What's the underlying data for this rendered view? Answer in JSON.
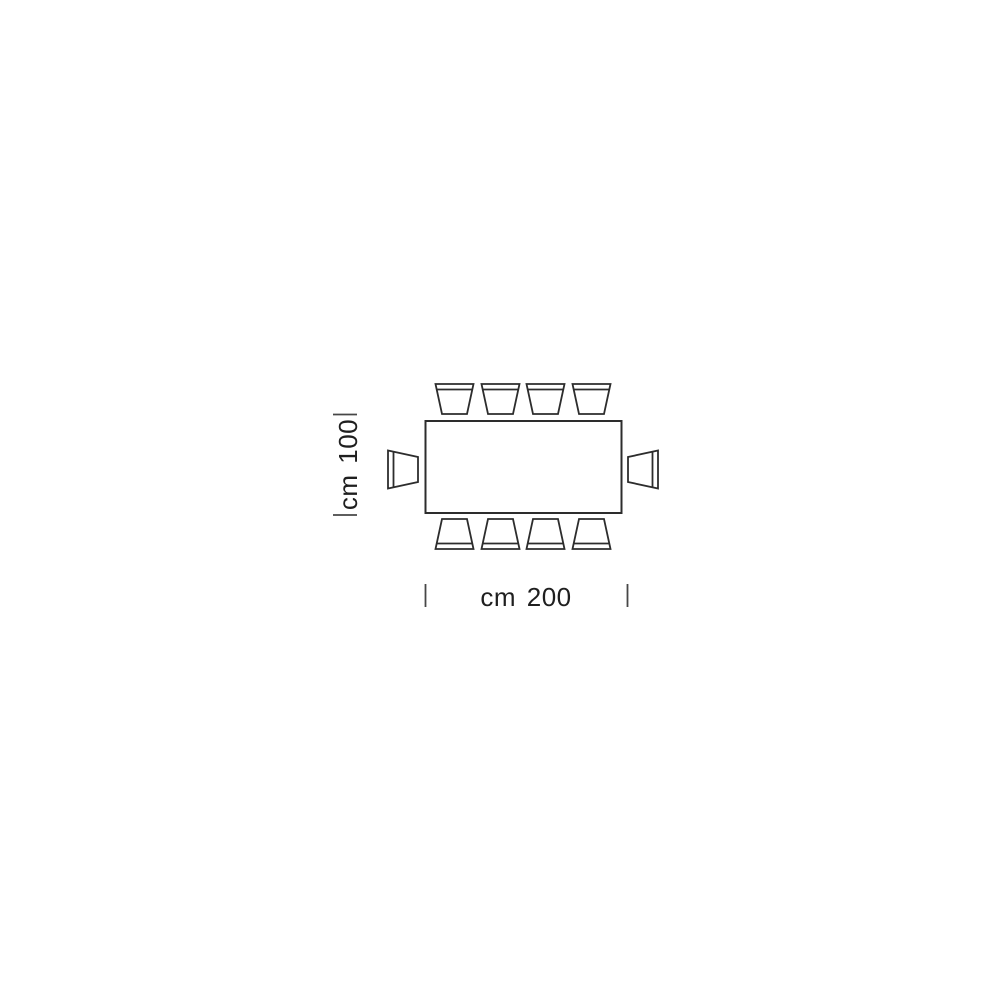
{
  "diagram": {
    "type": "furniture-plan-dimension-drawing",
    "subject": "rectangular table plan view with 10 chairs",
    "dimensions": {
      "width_label": "cm 200",
      "depth_label": "cm 100",
      "width_cm": 200,
      "depth_cm": 100
    },
    "seats": {
      "top": 4,
      "bottom": 4,
      "left": 1,
      "right": 1,
      "total": 10
    },
    "colors": {
      "line": "#2d2d2d",
      "tick": "#474747",
      "label_text": "#1f1f1f",
      "background": "#ffffff"
    }
  }
}
